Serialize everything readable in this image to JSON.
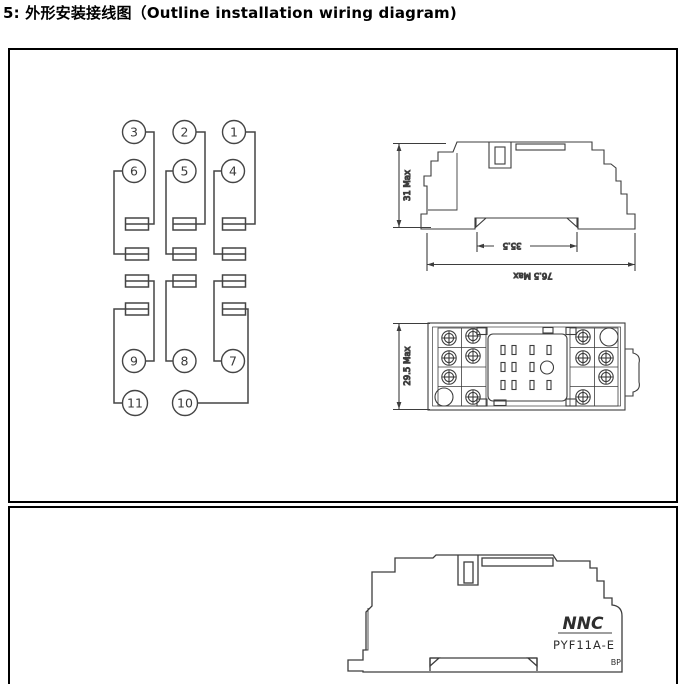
{
  "page": {
    "title": "5: 外形安装接线图（Outline installation wiring diagram)"
  },
  "wiring_diagram": {
    "pins": [
      "3",
      "2",
      "1",
      "6",
      "5",
      "4",
      "9",
      "8",
      "7",
      "11",
      "10"
    ]
  },
  "side_view": {
    "height": "31 Max",
    "rail_width": "35.5",
    "overall_width": "76.5 Max"
  },
  "top_view": {
    "depth": "29.5 Max"
  },
  "product_view": {
    "brand": "NNC",
    "model": "PYF11A-E",
    "marking": "BP"
  },
  "colors": {
    "line": "#3d3d3d",
    "border": "#000000",
    "background": "#ffffff"
  }
}
